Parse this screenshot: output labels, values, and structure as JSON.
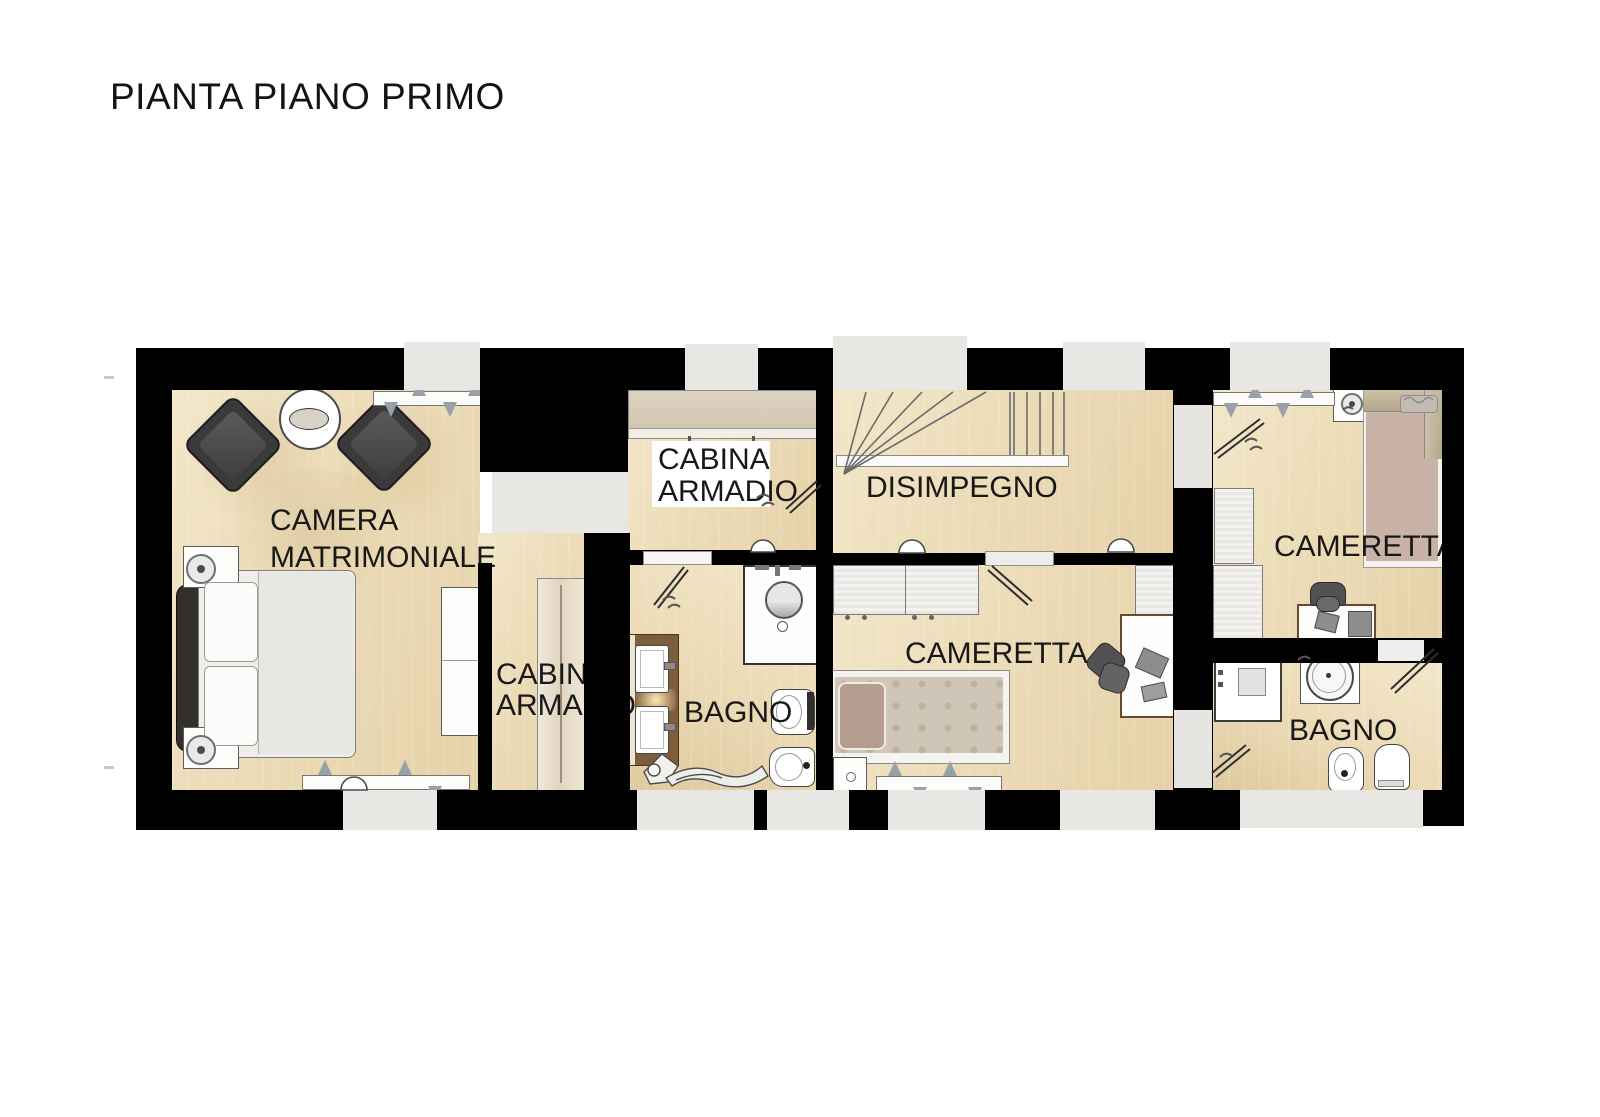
{
  "title": "PIANTA PIANO PRIMO",
  "rooms": {
    "master_bedroom": {
      "label_line1": "CAMERA",
      "label_line2": "MATRIMONIALE"
    },
    "walk_in_closet_top": {
      "label_line1": "CABINA",
      "label_line2": "ARMADIO"
    },
    "walk_in_closet_side": {
      "label_line1": "CABINA",
      "label_line2": "ARMADIO"
    },
    "hallway": {
      "label": "DISIMPEGNO"
    },
    "bathroom_main": {
      "label": "BAGNO"
    },
    "bedroom_left": {
      "label": "CAMERETTA"
    },
    "bedroom_right": {
      "label": "CAMERETTA"
    },
    "bathroom_right": {
      "label": "BAGNO"
    }
  },
  "colors": {
    "wall": "#000000",
    "floor_wood": "#ecdcb8",
    "window_opening": "#e9e7e4",
    "armchair_dark": "#3a3a3a",
    "bed_right_mattress": "#c9b3a7",
    "bed_left_duvet": "#cfc6b7",
    "vanity_wood": "#7e5d3a",
    "label_text": "#181818"
  }
}
